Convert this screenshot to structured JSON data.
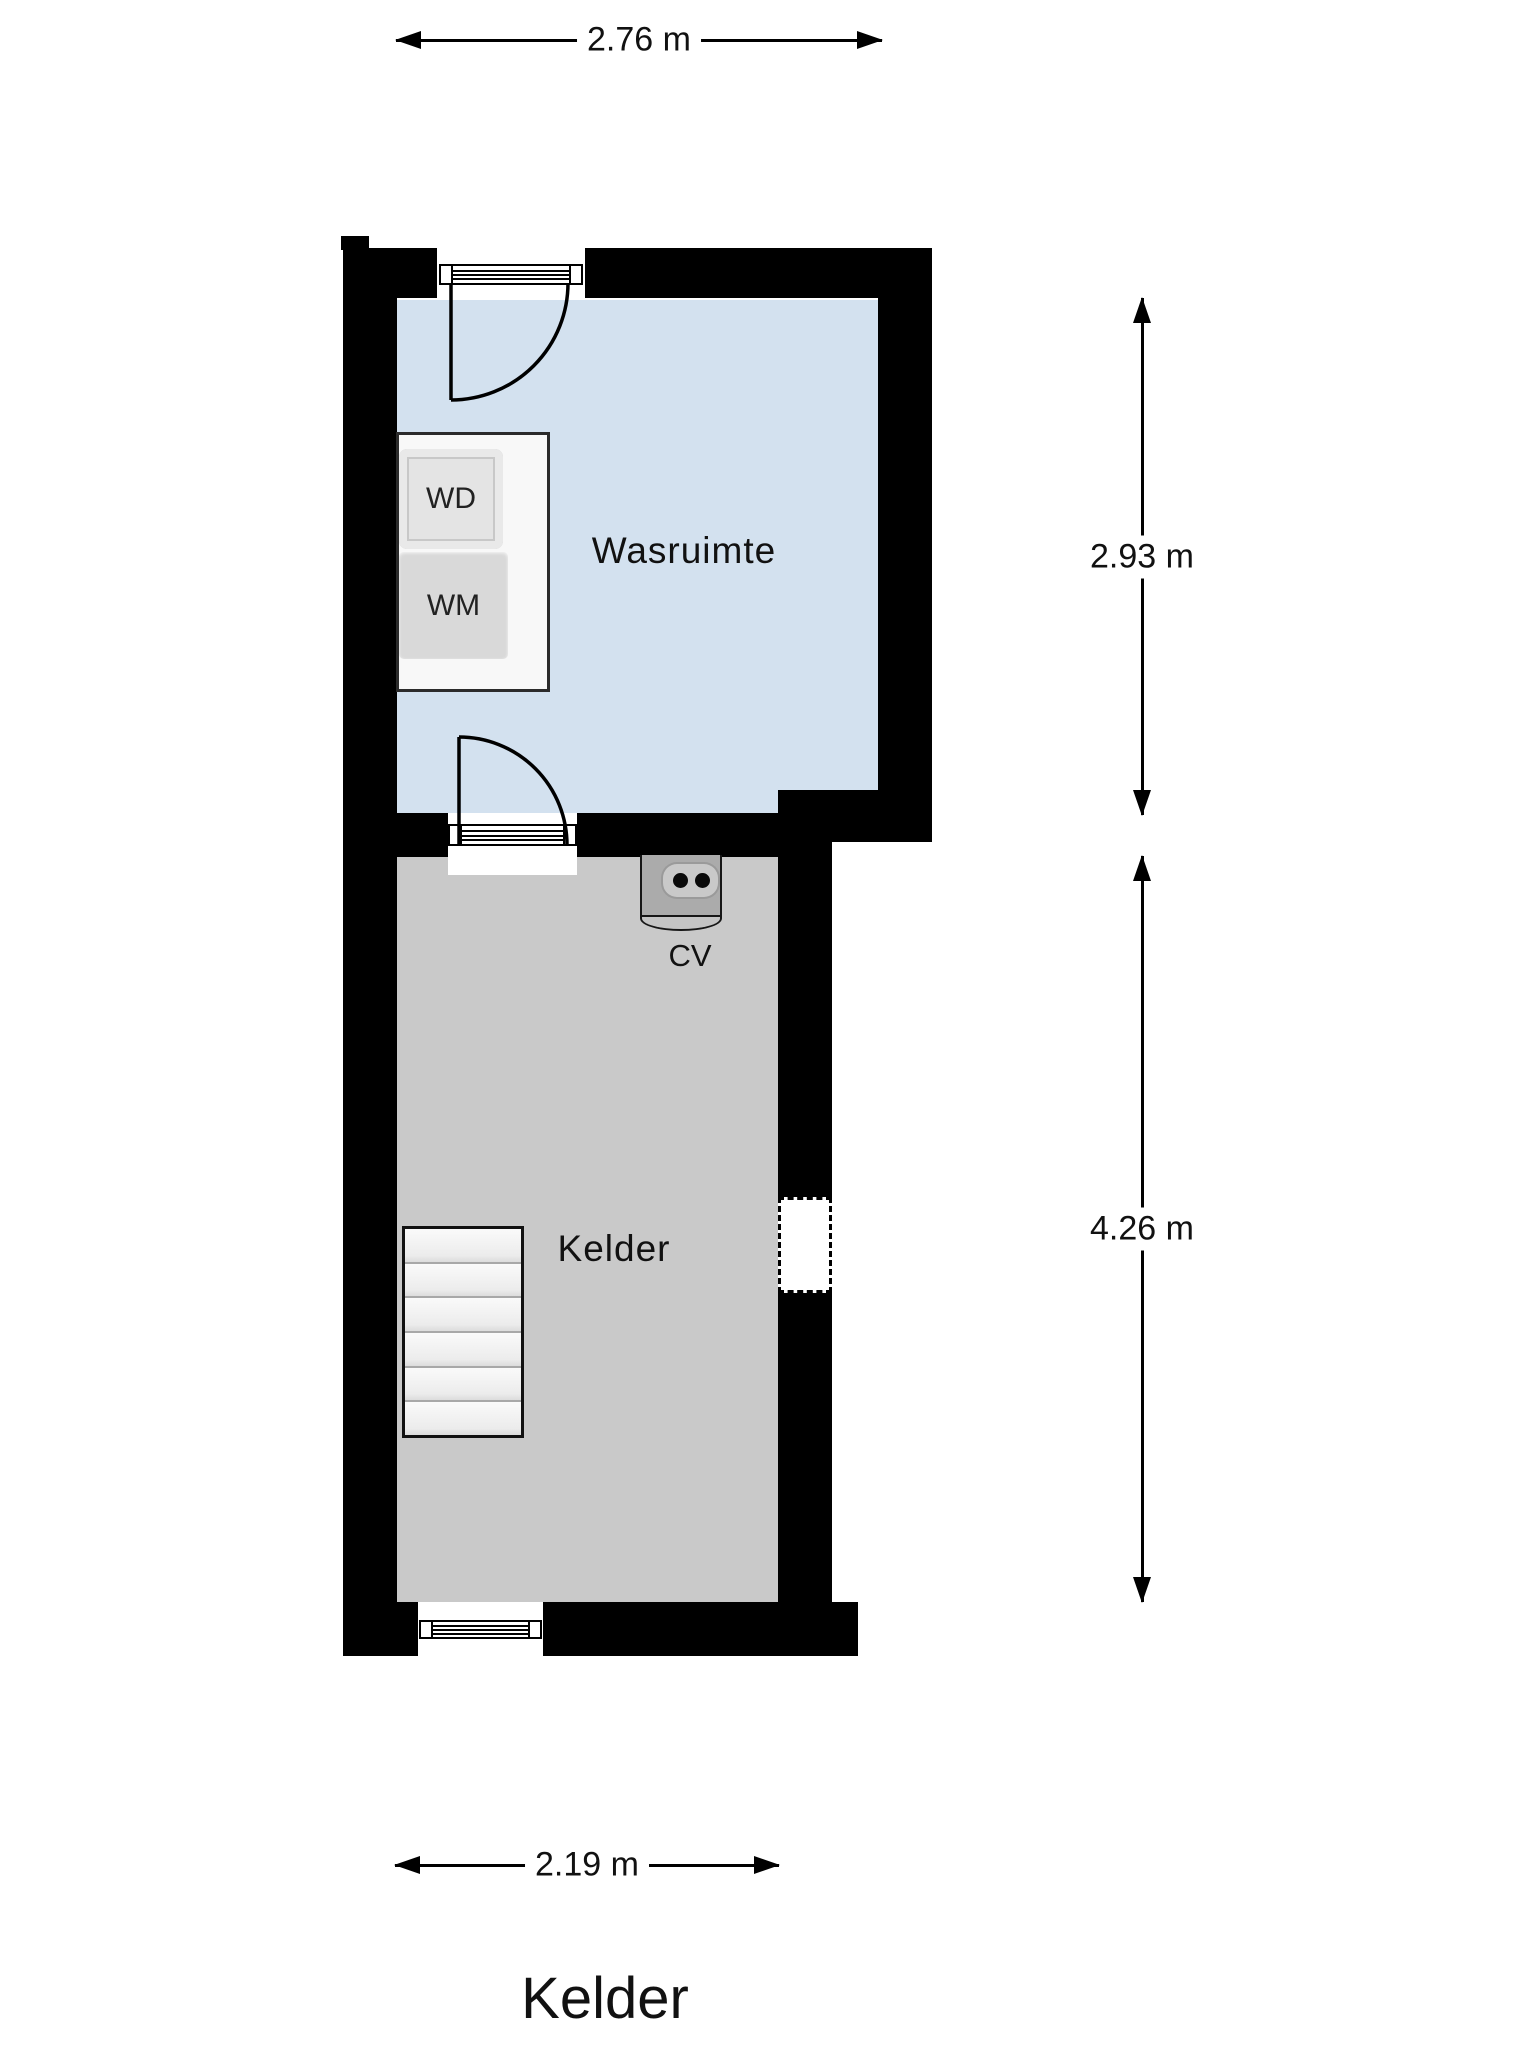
{
  "title": "Kelder",
  "rooms": {
    "laundry": {
      "label": "Wasruimte"
    },
    "basement": {
      "label": "Kelder"
    }
  },
  "appliances": {
    "dryer": "WD",
    "washer": "WM",
    "boiler": "CV"
  },
  "dimensions": {
    "top_width": "2.76 m",
    "laundry_height": "2.93 m",
    "basement_height": "4.26 m",
    "bottom_width": "2.19 m"
  },
  "colors": {
    "wall": "#000000",
    "floor-laundry": "#d3e1ef",
    "floor-kelder": "#c9c9c9"
  }
}
